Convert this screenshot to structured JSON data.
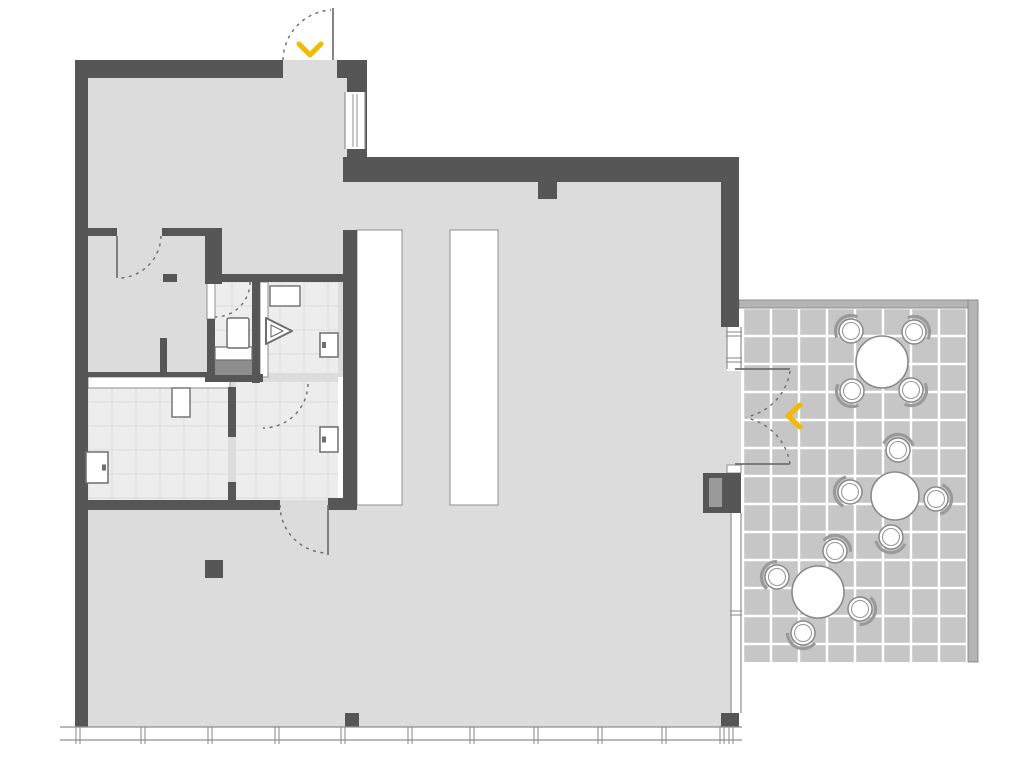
{
  "image_type": "architectural-floor-plan",
  "colors": {
    "wall": "#565656",
    "floor": "#dcdcdc",
    "bathTile": "#ededed",
    "bathGrid": "#dbdbdb",
    "patioTile": "#c6c6c6",
    "patioGrid": "#ffffff",
    "patioBorder": "#b4b4b4",
    "borderStroke": "#878787",
    "stripStroke": "#8f8f8f",
    "windowLine": "#8f8f8f",
    "fixtureStroke": "#6e6e6e",
    "furnitureStroke": "#8a8a8a",
    "chairBack": "#9a9a9a",
    "dash": "#6b6b6b",
    "leaf": "#6f6f6f",
    "accent": "#f3ba00",
    "white": "#ffffff"
  },
  "canvas": {
    "w": 1024,
    "h": 765
  },
  "floors": [
    {
      "name": "floor-left-block",
      "x": 88,
      "y": 78,
      "w": 269,
      "h": 432
    },
    {
      "name": "floor-entry-threshold",
      "x": 283,
      "y": 60,
      "w": 54,
      "h": 18
    },
    {
      "name": "floor-main-hall",
      "x": 357,
      "y": 182,
      "w": 370,
      "h": 546
    },
    {
      "name": "floor-lower-left",
      "x": 88,
      "y": 510,
      "w": 269,
      "h": 218
    },
    {
      "name": "floor-hall-gap",
      "x": 343,
      "y": 182,
      "w": 14,
      "h": 48
    },
    {
      "name": "floor-patio-door-threshold",
      "x": 721,
      "y": 371,
      "w": 20,
      "h": 94
    },
    {
      "name": "floor-right-strip",
      "x": 721,
      "y": 513,
      "w": 12,
      "h": 200
    }
  ],
  "tiled": [
    {
      "name": "patio-tiles",
      "x": 743,
      "y": 302,
      "w": 225,
      "h": 360,
      "step": 28,
      "ox": 743,
      "oy": 280,
      "fill": "patioTile",
      "grid": "patioGrid",
      "gw": 2.4
    },
    {
      "name": "wc-tiles",
      "x": 215,
      "y": 282,
      "w": 37,
      "h": 93,
      "step": 24,
      "ox": 88,
      "oy": 282,
      "fill": "bathTile",
      "grid": "bathGrid",
      "gw": 1
    },
    {
      "name": "shower-tiles",
      "x": 268,
      "y": 282,
      "w": 70,
      "h": 91,
      "step": 24,
      "ox": 88,
      "oy": 282,
      "fill": "bathTile",
      "grid": "bathGrid",
      "gw": 1
    },
    {
      "name": "laundry-tiles",
      "x": 88,
      "y": 388,
      "w": 140,
      "h": 112,
      "step": 24,
      "ox": 88,
      "oy": 282,
      "fill": "bathTile",
      "grid": "bathGrid",
      "gw": 1
    },
    {
      "name": "laundry-annex-tiles",
      "x": 236,
      "y": 382,
      "w": 102,
      "h": 118,
      "step": 24,
      "ox": 88,
      "oy": 282,
      "fill": "bathTile",
      "grid": "bathGrid",
      "gw": 1
    }
  ],
  "patio_border": [
    {
      "name": "patio-border-top",
      "x": 739,
      "y": 300,
      "w": 239,
      "h": 8
    },
    {
      "name": "patio-border-right",
      "x": 968,
      "y": 300,
      "w": 10,
      "h": 362
    }
  ],
  "strips": [
    {
      "name": "hall-counter-1",
      "x": 357,
      "y": 230,
      "w": 45,
      "h": 275
    },
    {
      "name": "hall-counter-2",
      "x": 450,
      "y": 230,
      "w": 48,
      "h": 275
    },
    {
      "name": "laundry-counter",
      "x": 88,
      "y": 377,
      "w": 142,
      "h": 11
    },
    {
      "name": "wc-door-panel",
      "x": 207,
      "y": 282,
      "w": 8,
      "h": 37
    },
    {
      "name": "shower-partition-panel",
      "x": 260,
      "y": 282,
      "w": 8,
      "h": 95
    },
    {
      "name": "wall-face-strip",
      "x": 338,
      "y": 377,
      "w": 5,
      "h": 123,
      "noStroke": true
    },
    {
      "name": "patio-door-frame-piece",
      "x": 727,
      "y": 465,
      "w": 14,
      "h": 8
    }
  ],
  "walls": [
    {
      "name": "outer-wall-left",
      "x": 75,
      "y": 60,
      "w": 13,
      "h": 670
    },
    {
      "name": "outer-wall-top",
      "x": 75,
      "y": 60,
      "w": 208,
      "h": 18
    },
    {
      "name": "outer-wall-top-right",
      "x": 337,
      "y": 60,
      "w": 30,
      "h": 18
    },
    {
      "name": "entry-side-wall",
      "x": 347,
      "y": 78,
      "w": 20,
      "h": 79
    },
    {
      "name": "hall-top-wall",
      "x": 343,
      "y": 157,
      "w": 396,
      "h": 25
    },
    {
      "name": "outer-wall-right-upper",
      "x": 721,
      "y": 182,
      "w": 18,
      "h": 145
    },
    {
      "name": "hall-pier",
      "x": 538,
      "y": 182,
      "w": 19,
      "h": 17
    },
    {
      "name": "room-a-wall-left",
      "x": 88,
      "y": 228,
      "w": 29,
      "h": 8
    },
    {
      "name": "room-a-wall-right",
      "x": 162,
      "y": 228,
      "w": 60,
      "h": 8
    },
    {
      "name": "room-a-corner-wall",
      "x": 205,
      "y": 228,
      "w": 17,
      "h": 56
    },
    {
      "name": "corridor-wall-stub",
      "x": 163,
      "y": 274,
      "w": 14,
      "h": 8
    },
    {
      "name": "shower-top-wall",
      "x": 222,
      "y": 274,
      "w": 135,
      "h": 8
    },
    {
      "name": "wc-left-wall",
      "x": 207,
      "y": 319,
      "w": 8,
      "h": 58
    },
    {
      "name": "wc-shower-wall",
      "x": 252,
      "y": 282,
      "w": 8,
      "h": 101
    },
    {
      "name": "corridor-stub-wall",
      "x": 160,
      "y": 338,
      "w": 7,
      "h": 39
    },
    {
      "name": "laundry-top-wall",
      "x": 88,
      "y": 372,
      "w": 142,
      "h": 5
    },
    {
      "name": "wc-bottom-wall",
      "x": 205,
      "y": 374,
      "w": 58,
      "h": 8
    },
    {
      "name": "annex-stub-upper",
      "x": 228,
      "y": 387,
      "w": 8,
      "h": 50
    },
    {
      "name": "annex-stub-lower",
      "x": 228,
      "y": 482,
      "w": 8,
      "h": 28
    },
    {
      "name": "hall-left-wall",
      "x": 343,
      "y": 230,
      "w": 14,
      "h": 275
    },
    {
      "name": "laundry-bottom-wall",
      "x": 88,
      "y": 500,
      "w": 192,
      "h": 10
    },
    {
      "name": "laundry-bottom-wall-right",
      "x": 328,
      "y": 498,
      "w": 29,
      "h": 12
    },
    {
      "name": "column-hall",
      "x": 205,
      "y": 560,
      "w": 18,
      "h": 18
    },
    {
      "name": "column-south",
      "x": 345,
      "y": 713,
      "w": 14,
      "h": 15
    },
    {
      "name": "column-southeast",
      "x": 721,
      "y": 713,
      "w": 18,
      "h": 15
    },
    {
      "name": "wall-unit-block",
      "x": 703,
      "y": 473,
      "w": 38,
      "h": 40
    }
  ],
  "accents": [
    {
      "name": "wall-unit-inner",
      "x": 709,
      "y": 478,
      "w": 13,
      "h": 29,
      "fill": "#9a9a9a"
    },
    {
      "name": "wc-tray",
      "x": 215,
      "y": 360,
      "w": 37,
      "h": 15,
      "fill": "#8d8d8d"
    }
  ],
  "windows": [
    {
      "name": "south-window-band",
      "x": 60,
      "y": 727,
      "w": 682,
      "h": 13,
      "orient": "h",
      "mullions": [
        78,
        143,
        210,
        277,
        343,
        410,
        472,
        536,
        600,
        664,
        722,
        731
      ],
      "center": false
    },
    {
      "name": "entry-window",
      "x": 345,
      "y": 92,
      "w": 20,
      "h": 57,
      "orient": "v",
      "mullions": [],
      "center": true
    },
    {
      "name": "patio-door-sidelight",
      "x": 727,
      "y": 327,
      "w": 14,
      "h": 42,
      "orient": "v",
      "mullions": [
        334,
        360
      ],
      "center": false
    },
    {
      "name": "east-glazing",
      "x": 731,
      "y": 513,
      "w": 10,
      "h": 200,
      "orient": "v",
      "mullions": [
        613
      ],
      "center": false
    }
  ],
  "fixtures": {
    "radiators": [
      {
        "name": "radiator-laundry",
        "x": 86,
        "y": 452,
        "w": 22,
        "h": 31,
        "notch": "right"
      },
      {
        "name": "radiator-shower",
        "x": 320,
        "y": 333,
        "w": 18,
        "h": 24,
        "notch": "left"
      },
      {
        "name": "radiator-annex",
        "x": 320,
        "y": 427,
        "w": 18,
        "h": 25,
        "notch": "left"
      }
    ],
    "sinks": [
      {
        "name": "laundry-sink",
        "x": 172,
        "y": 388,
        "w": 18,
        "h": 29
      },
      {
        "name": "shower-sink",
        "x": 270,
        "y": 286,
        "w": 30,
        "h": 20
      }
    ],
    "toilet": {
      "name": "wc-toilet",
      "x": 227,
      "y": 318,
      "w": 22,
      "h": 30,
      "shelf": {
        "x": 215,
        "y": 347,
        "w": 37,
        "h": 13
      }
    },
    "shower_symbol": {
      "name": "shower-symbol",
      "outer": "266,318 292,331 266,344",
      "inner": "271,325 283,331 271,337"
    }
  },
  "doors": {
    "leaves": [
      {
        "name": "entry-door-leaf",
        "x1": 333,
        "y1": 8,
        "x2": 333,
        "y2": 60
      },
      {
        "name": "room-a-door-leaf",
        "x1": 117,
        "y1": 236,
        "x2": 117,
        "y2": 278
      },
      {
        "name": "laundry-exit-door-leaf",
        "x1": 328,
        "y1": 505,
        "x2": 328,
        "y2": 555
      },
      {
        "name": "patio-door-leaf-top",
        "x1": 735,
        "y1": 369,
        "x2": 790,
        "y2": 369
      },
      {
        "name": "patio-door-leaf-bottom",
        "x1": 735,
        "y1": 464,
        "x2": 790,
        "y2": 464
      }
    ],
    "arcs": [
      {
        "name": "entry-door-swing",
        "d": "M283,60 A51,51 0 0 1 331,10"
      },
      {
        "name": "room-a-door-swing",
        "d": "M161,236 A43,43 0 0 1 117,278"
      },
      {
        "name": "wc-door-swing",
        "d": "M250,282 A35,35 0 0 1 215,317"
      },
      {
        "name": "shower-door-swing",
        "d": "M308,384 A45,45 0 0 1 263,428"
      },
      {
        "name": "laundry-exit-door-swing",
        "d": "M280,505 A48,48 0 0 0 328,553"
      },
      {
        "name": "patio-door-swing-top",
        "d": "M790,371 A55,55 0 0 1 746,417"
      },
      {
        "name": "patio-door-swing-bottom",
        "d": "M790,464 A55,55 0 0 0 746,418"
      }
    ],
    "chevrons": [
      {
        "name": "entry-direction-chevron",
        "points": "299,44 310,55 321,44"
      },
      {
        "name": "patio-direction-chevron",
        "points": "800,405 788,416 800,427"
      }
    ]
  },
  "furniture": {
    "tables": [
      {
        "name": "patio-table-1",
        "cx": 882,
        "cy": 362,
        "r": 26
      },
      {
        "name": "patio-table-2",
        "cx": 895,
        "cy": 496,
        "r": 24
      },
      {
        "name": "patio-table-3",
        "cx": 818,
        "cy": 592,
        "r": 26
      }
    ],
    "chairs": [
      {
        "cx": 851,
        "cy": 331,
        "t": 0
      },
      {
        "cx": 914,
        "cy": 332,
        "t": 0
      },
      {
        "cx": 852,
        "cy": 391,
        "t": 0
      },
      {
        "cx": 911,
        "cy": 390,
        "t": 0
      },
      {
        "cx": 898,
        "cy": 450,
        "t": 1
      },
      {
        "cx": 850,
        "cy": 492,
        "t": 1
      },
      {
        "cx": 936,
        "cy": 499,
        "t": 1
      },
      {
        "cx": 891,
        "cy": 537,
        "t": 1
      },
      {
        "cx": 835,
        "cy": 551,
        "t": 2
      },
      {
        "cx": 777,
        "cy": 577,
        "t": 2
      },
      {
        "cx": 860,
        "cy": 609,
        "t": 2
      },
      {
        "cx": 803,
        "cy": 633,
        "t": 2
      }
    ]
  }
}
